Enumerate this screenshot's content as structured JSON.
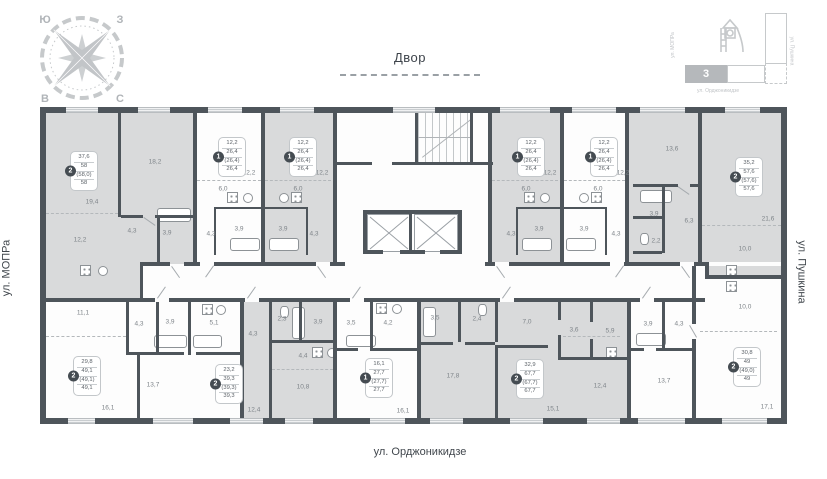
{
  "compass": {
    "nw": "Ю",
    "ne": "З",
    "sw": "В",
    "se": "С"
  },
  "courtyard": {
    "label": "Двор"
  },
  "streets": {
    "left": "ул. МОПРа",
    "right": "ул. Пушкина",
    "bottom": "ул. Орджоникидзе"
  },
  "minimap": {
    "building_number": "3",
    "street_left": "ул. МОПРа",
    "street_right": "ул. Пушкина",
    "street_bottom": "ул. Орджоникидзе"
  },
  "colors": {
    "wall": "#4e555b",
    "room_shaded": "#d9dadb",
    "badge_circle": "#454c52",
    "area_text": "#7e8489",
    "light_outline": "#c6c9cb"
  },
  "apartments": [
    {
      "type": "2",
      "area_lines": [
        "37,6",
        "58",
        "(58,0)",
        "58"
      ],
      "badge": {
        "x": 30,
        "y": 44
      }
    },
    {
      "type": "1",
      "area_lines": [
        "12,2",
        "26,4",
        "(26,4)",
        "26,4"
      ],
      "badge": {
        "x": 178,
        "y": 30
      }
    },
    {
      "type": "1",
      "area_lines": [
        "12,2",
        "26,4",
        "(26,4)",
        "26,4"
      ],
      "badge": {
        "x": 249,
        "y": 30
      }
    },
    {
      "type": "1",
      "area_lines": [
        "12,2",
        "26,4",
        "(26,4)",
        "26,4"
      ],
      "badge": {
        "x": 477,
        "y": 30
      }
    },
    {
      "type": "1",
      "area_lines": [
        "12,2",
        "26,4",
        "(26,4)",
        "26,4"
      ],
      "badge": {
        "x": 550,
        "y": 30
      }
    },
    {
      "type": "2",
      "area_lines": [
        "35,2",
        "57,6",
        "(57,6)",
        "57,6"
      ],
      "badge": {
        "x": 695,
        "y": 50
      }
    },
    {
      "type": "2",
      "area_lines": [
        "29,8",
        "49,1",
        "(49,1)",
        "49,1"
      ],
      "badge": {
        "x": 33,
        "y": 249
      }
    },
    {
      "type": "2",
      "area_lines": [
        "23,2",
        "39,3",
        "(39,3)",
        "39,3"
      ],
      "badge": {
        "x": 175,
        "y": 257
      }
    },
    {
      "type": "1",
      "area_lines": [
        "16,1",
        "27,7",
        "(27,7)",
        "27,7"
      ],
      "badge": {
        "x": 325,
        "y": 251
      }
    },
    {
      "type": "2",
      "area_lines": [
        "32,9",
        "67,7",
        "(67,7)",
        "67,7"
      ],
      "badge": {
        "x": 476,
        "y": 252
      }
    },
    {
      "type": "2",
      "area_lines": [
        "30,8",
        "49",
        "(49,0)",
        "49"
      ],
      "badge": {
        "x": 693,
        "y": 240
      }
    }
  ],
  "room_labels": [
    {
      "text": "19,4",
      "x": 52,
      "y": 95
    },
    {
      "text": "18,2",
      "x": 115,
      "y": 55
    },
    {
      "text": "12,2",
      "x": 40,
      "y": 133
    },
    {
      "text": "4,3",
      "x": 92,
      "y": 124
    },
    {
      "text": "3,9",
      "x": 127,
      "y": 126
    },
    {
      "text": "12,2",
      "x": 209,
      "y": 66
    },
    {
      "text": "6,0",
      "x": 183,
      "y": 82
    },
    {
      "text": "3,9",
      "x": 199,
      "y": 122
    },
    {
      "text": "4,3",
      "x": 171,
      "y": 127
    },
    {
      "text": "12,2",
      "x": 282,
      "y": 66
    },
    {
      "text": "6,0",
      "x": 258,
      "y": 82
    },
    {
      "text": "3,9",
      "x": 243,
      "y": 122
    },
    {
      "text": "4,3",
      "x": 274,
      "y": 127
    },
    {
      "text": "12,2",
      "x": 510,
      "y": 66
    },
    {
      "text": "6,0",
      "x": 486,
      "y": 82
    },
    {
      "text": "3,9",
      "x": 499,
      "y": 122
    },
    {
      "text": "4,3",
      "x": 471,
      "y": 127
    },
    {
      "text": "12,2",
      "x": 583,
      "y": 66
    },
    {
      "text": "6,0",
      "x": 558,
      "y": 82
    },
    {
      "text": "3,9",
      "x": 544,
      "y": 122
    },
    {
      "text": "4,3",
      "x": 576,
      "y": 127
    },
    {
      "text": "13,6",
      "x": 632,
      "y": 42
    },
    {
      "text": "3,9",
      "x": 614,
      "y": 107
    },
    {
      "text": "6,3",
      "x": 649,
      "y": 114
    },
    {
      "text": "2,2",
      "x": 616,
      "y": 134
    },
    {
      "text": "21,6",
      "x": 728,
      "y": 112
    },
    {
      "text": "10,0",
      "x": 705,
      "y": 142
    },
    {
      "text": "11,1",
      "x": 43,
      "y": 206
    },
    {
      "text": "4,3",
      "x": 99,
      "y": 217
    },
    {
      "text": "3,9",
      "x": 130,
      "y": 215
    },
    {
      "text": "5,1",
      "x": 174,
      "y": 216
    },
    {
      "text": "13,7",
      "x": 113,
      "y": 278
    },
    {
      "text": "16,1",
      "x": 68,
      "y": 301
    },
    {
      "text": "4,3",
      "x": 213,
      "y": 227
    },
    {
      "text": "2,3",
      "x": 242,
      "y": 212
    },
    {
      "text": "3,9",
      "x": 278,
      "y": 215
    },
    {
      "text": "4,4",
      "x": 263,
      "y": 249
    },
    {
      "text": "10,8",
      "x": 263,
      "y": 280
    },
    {
      "text": "12,4",
      "x": 214,
      "y": 303
    },
    {
      "text": "3,5",
      "x": 311,
      "y": 216
    },
    {
      "text": "4,2",
      "x": 348,
      "y": 216
    },
    {
      "text": "16,1",
      "x": 363,
      "y": 304
    },
    {
      "text": "3,5",
      "x": 395,
      "y": 211
    },
    {
      "text": "2,4",
      "x": 437,
      "y": 212
    },
    {
      "text": "7,0",
      "x": 487,
      "y": 215
    },
    {
      "text": "3,6",
      "x": 534,
      "y": 223
    },
    {
      "text": "5,9",
      "x": 570,
      "y": 224
    },
    {
      "text": "17,8",
      "x": 413,
      "y": 269
    },
    {
      "text": "15,1",
      "x": 513,
      "y": 302
    },
    {
      "text": "12,4",
      "x": 560,
      "y": 279
    },
    {
      "text": "3,9",
      "x": 608,
      "y": 217
    },
    {
      "text": "4,3",
      "x": 639,
      "y": 217
    },
    {
      "text": "13,7",
      "x": 624,
      "y": 274
    },
    {
      "text": "10,0",
      "x": 705,
      "y": 200
    },
    {
      "text": "17,1",
      "x": 727,
      "y": 300
    }
  ]
}
